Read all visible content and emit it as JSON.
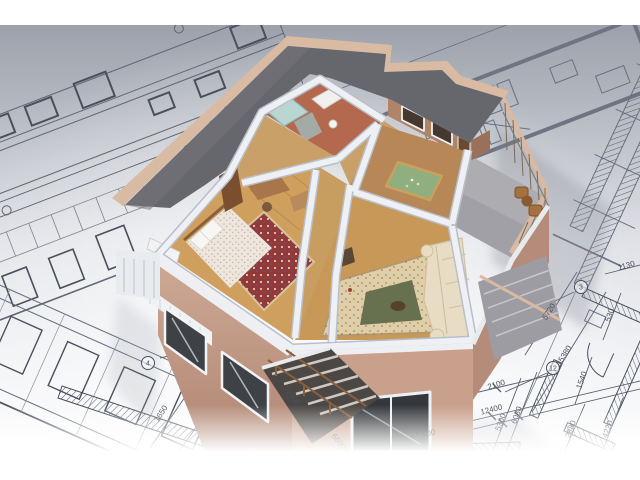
{
  "meta": {
    "subject": "3D cutaway model of a two-story house standing on architectural blueprint drawings",
    "view": "isometric aerial render"
  },
  "canvas": {
    "width": 640,
    "height": 480,
    "letterbox_color": "#ffffff"
  },
  "colors": {
    "paper_dark": "#989da7",
    "paper_light": "#f2f3f5",
    "blueprint_line": "#5a6170",
    "blueprint_line_dark": "#49505c",
    "roof": "#66676c",
    "parapet_beige": "#d9baa3",
    "wall_white": "#eef0f4",
    "facade_beige": "#c9a18d",
    "wood_floor": "#cf9f5e",
    "bedroom_rug": "#93393a",
    "living_rug": "#decfa8",
    "living_rug_center": "#67704f",
    "billiard_table": "#8fb07e",
    "sofa": "#e8ddc4",
    "terrace_floor": "#a0a0a6",
    "bath_fixture": "#b9d6d2",
    "bath_floor": "#b4684e",
    "stair_dark": "#4b4744",
    "wood_rail": "#8a5f3e"
  },
  "blueprint": {
    "dimension_labels": [
      {
        "text": "1650",
        "x": 163,
        "y": 415,
        "rot": -57
      },
      {
        "text": "16200",
        "x": 425,
        "y": 437,
        "rot": -14
      },
      {
        "text": "12400",
        "x": 492,
        "y": 412,
        "rot": -14
      },
      {
        "text": "2300",
        "x": 291,
        "y": 399,
        "rot": 50
      },
      {
        "text": "6600",
        "x": 337,
        "y": 443,
        "rot": 50
      },
      {
        "text": "2100",
        "x": 497,
        "y": 387,
        "rot": -17
      },
      {
        "text": "5300",
        "x": 503,
        "y": 423,
        "rot": -70
      },
      {
        "text": "6080",
        "x": 519,
        "y": 416,
        "rot": -70
      },
      {
        "text": "1130",
        "x": 627,
        "y": 268,
        "rot": -15
      },
      {
        "text": "530",
        "x": 612,
        "y": 316,
        "rot": -70
      },
      {
        "text": "5720",
        "x": 551,
        "y": 313,
        "rot": -58
      },
      {
        "text": "15380",
        "x": 566,
        "y": 357,
        "rot": -58
      },
      {
        "text": "1540",
        "x": 584,
        "y": 381,
        "rot": -70
      },
      {
        "text": "2880",
        "x": 573,
        "y": 430,
        "rot": -70
      },
      {
        "text": "4220",
        "x": 610,
        "y": 430,
        "rot": -70
      }
    ],
    "axis_bubbles": [
      {
        "text": "4",
        "x": 148,
        "y": 363
      },
      {
        "text": "3",
        "x": 581,
        "y": 287
      },
      {
        "text": "12",
        "x": 553,
        "y": 368
      }
    ]
  },
  "scene": {
    "rooms": [
      {
        "name": "bathroom"
      },
      {
        "name": "bedroom"
      },
      {
        "name": "billiard-room"
      },
      {
        "name": "living-room"
      },
      {
        "name": "corridor"
      },
      {
        "name": "terrace"
      },
      {
        "name": "stairwell"
      }
    ],
    "furniture": [
      "bed",
      "bedroom-rug",
      "desk",
      "wardrobe",
      "radiator",
      "billiard-table",
      "living-room-rug",
      "corner-sofa",
      "coffee-table",
      "bathtub",
      "vanity",
      "terrace-chairs",
      "terrace-table"
    ]
  }
}
